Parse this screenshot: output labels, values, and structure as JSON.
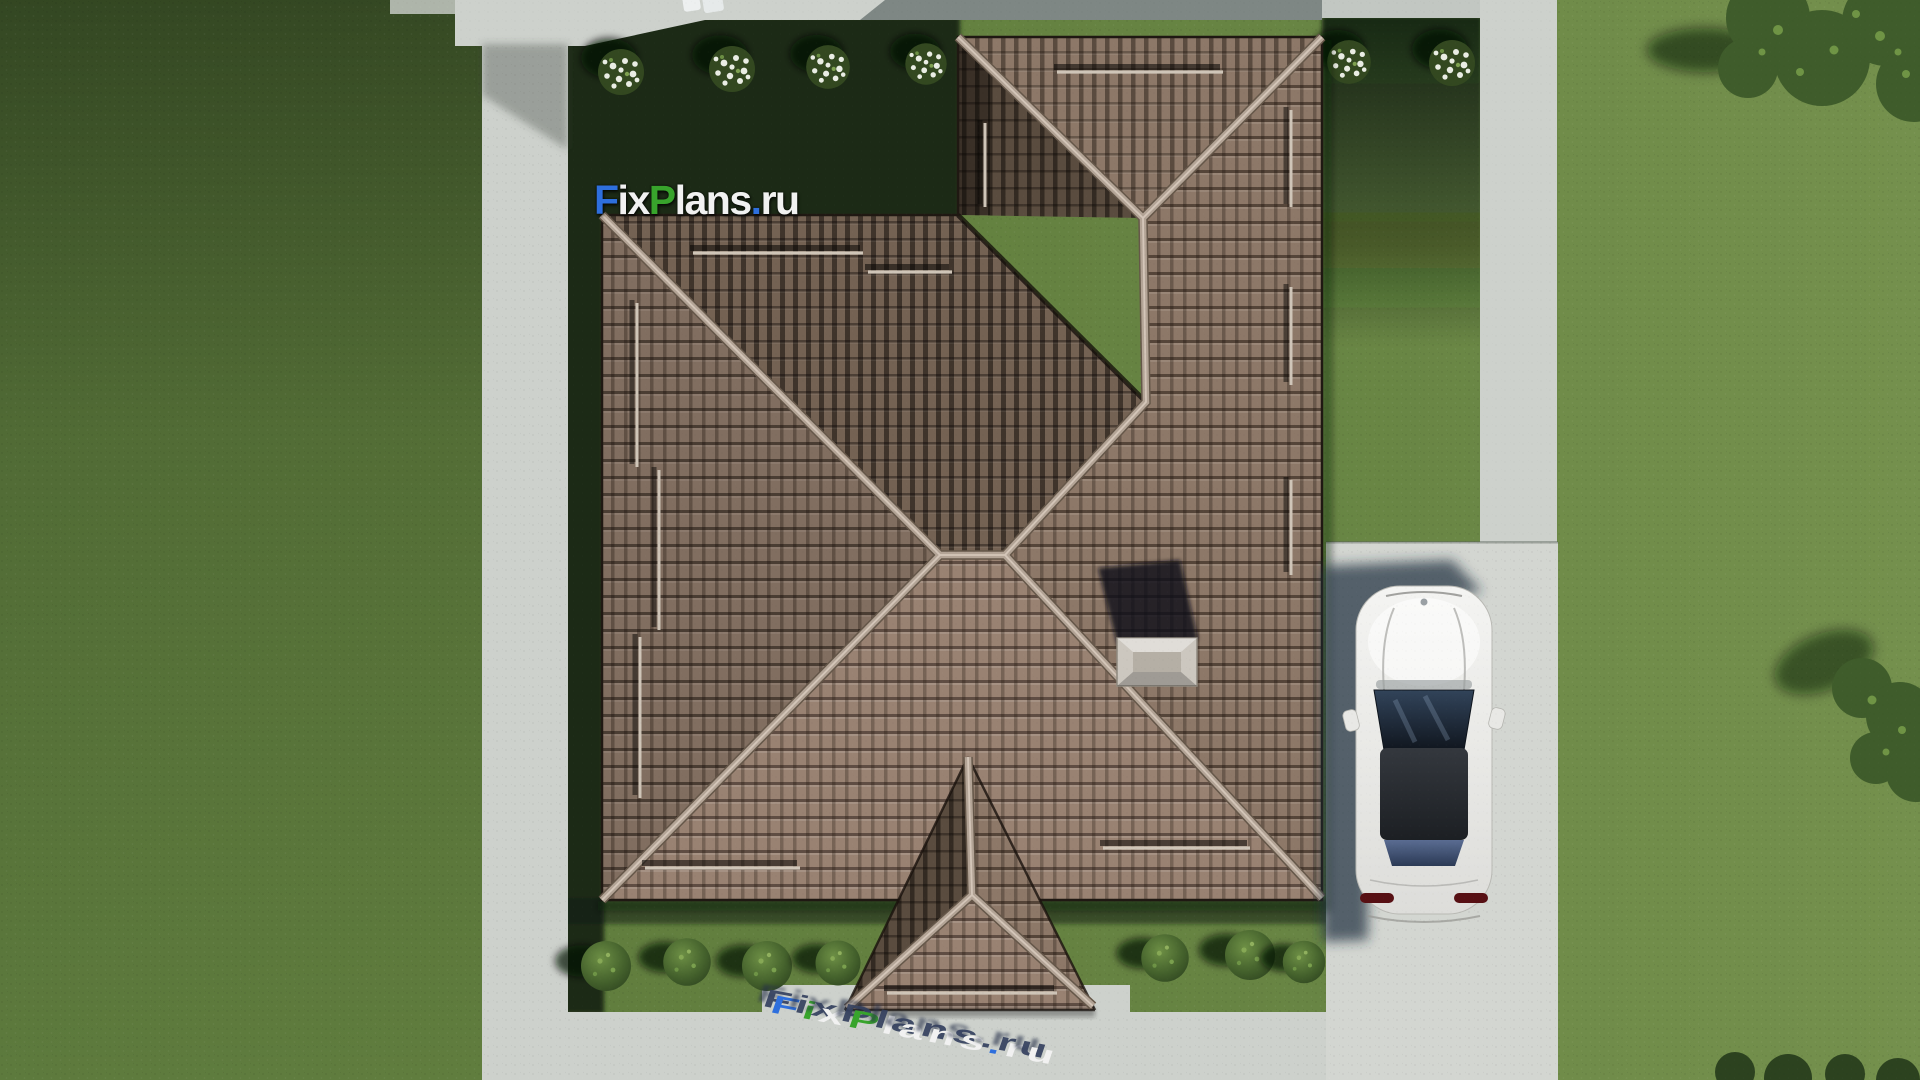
{
  "watermark": {
    "text": "FixPlans.ru",
    "parts": [
      {
        "text": "F",
        "color": "blue"
      },
      {
        "text": "ix",
        "color": "white"
      },
      {
        "text": "P",
        "color": "green"
      },
      {
        "text": "lans",
        "color": "white"
      },
      {
        "text": ".",
        "color": "blue"
      },
      {
        "text": "ru",
        "color": "white"
      }
    ]
  },
  "watermark_3d": {
    "text": "FixPlans.ru",
    "letters": [
      {
        "ch": "F",
        "color": "blue"
      },
      {
        "ch": "i",
        "color": "green"
      },
      {
        "ch": "x",
        "color": "white"
      },
      {
        "ch": "P",
        "color": "green"
      },
      {
        "ch": "l",
        "color": "white"
      },
      {
        "ch": "a",
        "color": "white"
      },
      {
        "ch": "n",
        "color": "white"
      },
      {
        "ch": "s",
        "color": "white"
      },
      {
        "ch": ".",
        "color": "blue"
      },
      {
        "ch": "r",
        "color": "white"
      },
      {
        "ch": "u",
        "color": "white"
      }
    ]
  },
  "colors": {
    "lawn-base": "#617e3e",
    "lawn-bright": "#6d8a49",
    "lawn-shadow": "#1e2c17",
    "path-light": "#cdd1cc",
    "driveway": "#d3d6d1",
    "roof-bright": "#998272",
    "roof-lit": "#8d7868",
    "roof-medium": "#816e60",
    "roof-dark": "#746253",
    "roof-wing-dark": "#5a4c3f",
    "ridge": "#b3a496",
    "chimney": "#ccc7bf",
    "car-body": "#ededeb",
    "car-glass": "#24313f",
    "car-roof": "#26292d",
    "bush-green": "#3f5c2b",
    "flower-white": "#eaede4",
    "logo-blue": "#2e6fdd",
    "logo-green": "#38a42c",
    "logo-white": "#f1f1f1"
  }
}
